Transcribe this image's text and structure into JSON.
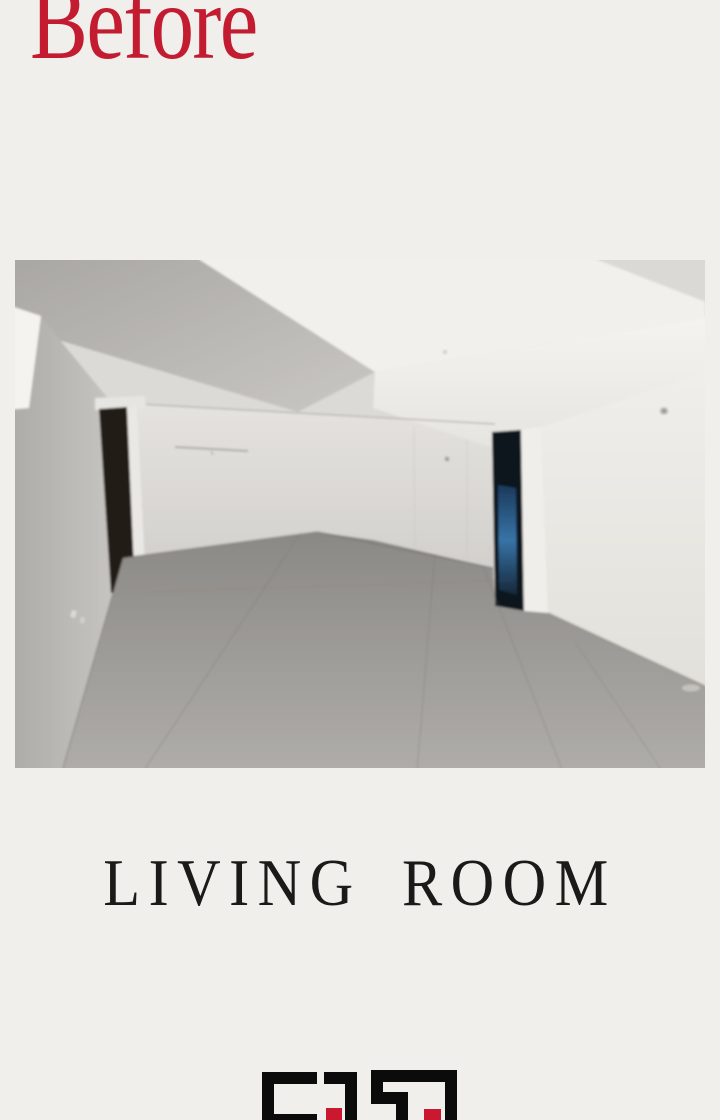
{
  "header": {
    "before_label": "Before",
    "before_color": "#c31c30"
  },
  "photo": {
    "description": "Empty unfurnished living room before renovation: white false ceiling with recessed tray, grey side wall, dark open door on the left, dark doorway with blue light at center-right, bright white right wall and grey tiled floor"
  },
  "caption": {
    "room_label": "LIVING ROOM",
    "room_label_color": "#1b1a18"
  },
  "logo": {
    "type": "geometric-maze-monogram",
    "black_hex": "#0b0b0b",
    "red_hex": "#c9182f"
  }
}
